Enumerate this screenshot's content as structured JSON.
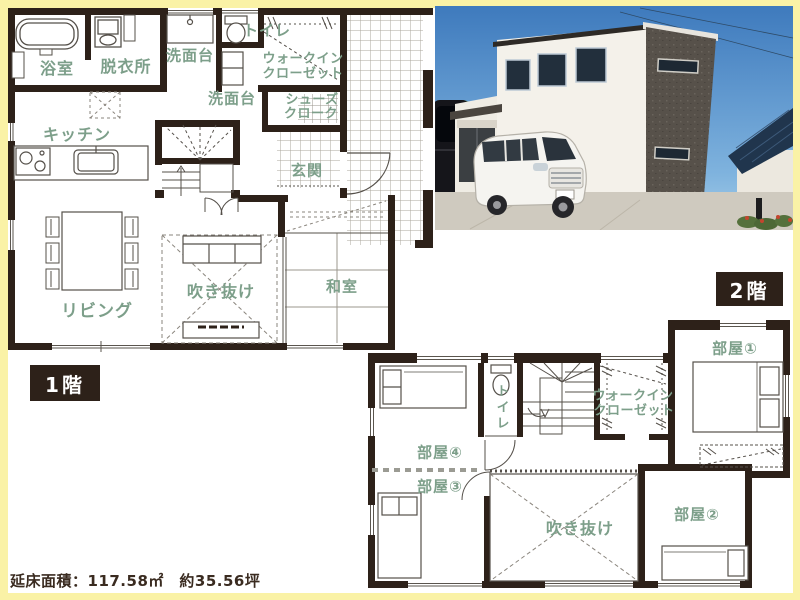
{
  "colors": {
    "background": "#faf2a6",
    "paper": "#ffffff",
    "wall": "#2d2119",
    "room_label_green": "#7d9f8a",
    "badge_background": "#2d2119",
    "badge_text": "#ffffff",
    "footer_text": "#3a2b20"
  },
  "floor1": {
    "badge": "1階",
    "rooms": {
      "bathroom": "浴室",
      "dressing_room": "脱衣所",
      "washstand_top": "洗面台",
      "toilet": "トイレ",
      "wic": {
        "line1": "ウォークイン",
        "line2": "クローゼット"
      },
      "washstand_hall": "洗面台",
      "shoes_closet": {
        "line1": "シューズ",
        "line2": "クローク"
      },
      "kitchen": "キッチン",
      "entrance": "玄関",
      "living": "リビング",
      "void": "吹き抜け",
      "japanese_room": "和室"
    }
  },
  "floor2": {
    "badge": "2階",
    "rooms": {
      "room1": "部屋①",
      "room2": "部屋②",
      "room3": "部屋③",
      "room4": "部屋④",
      "toilet": "トイレ",
      "wic": {
        "line1": "ウォークイン",
        "line2": "クローゼット"
      },
      "void": "吹き抜け"
    }
  },
  "footer": {
    "area_label": "延床面積：117.58㎡　約35.56坪"
  },
  "icons": [
    "bathtub-icon",
    "washing-machine-icon",
    "toilet-icon",
    "washstand-icon",
    "gas-stove-icon",
    "kitchen-sink-icon",
    "staircase-up-icon",
    "staircase-down-icon",
    "dining-table-icon",
    "sofa-icon",
    "tv-board-icon",
    "single-bed-icon",
    "double-bed-icon",
    "door-swing-icon",
    "hanger-pipe-icon",
    "exterior-photo"
  ]
}
